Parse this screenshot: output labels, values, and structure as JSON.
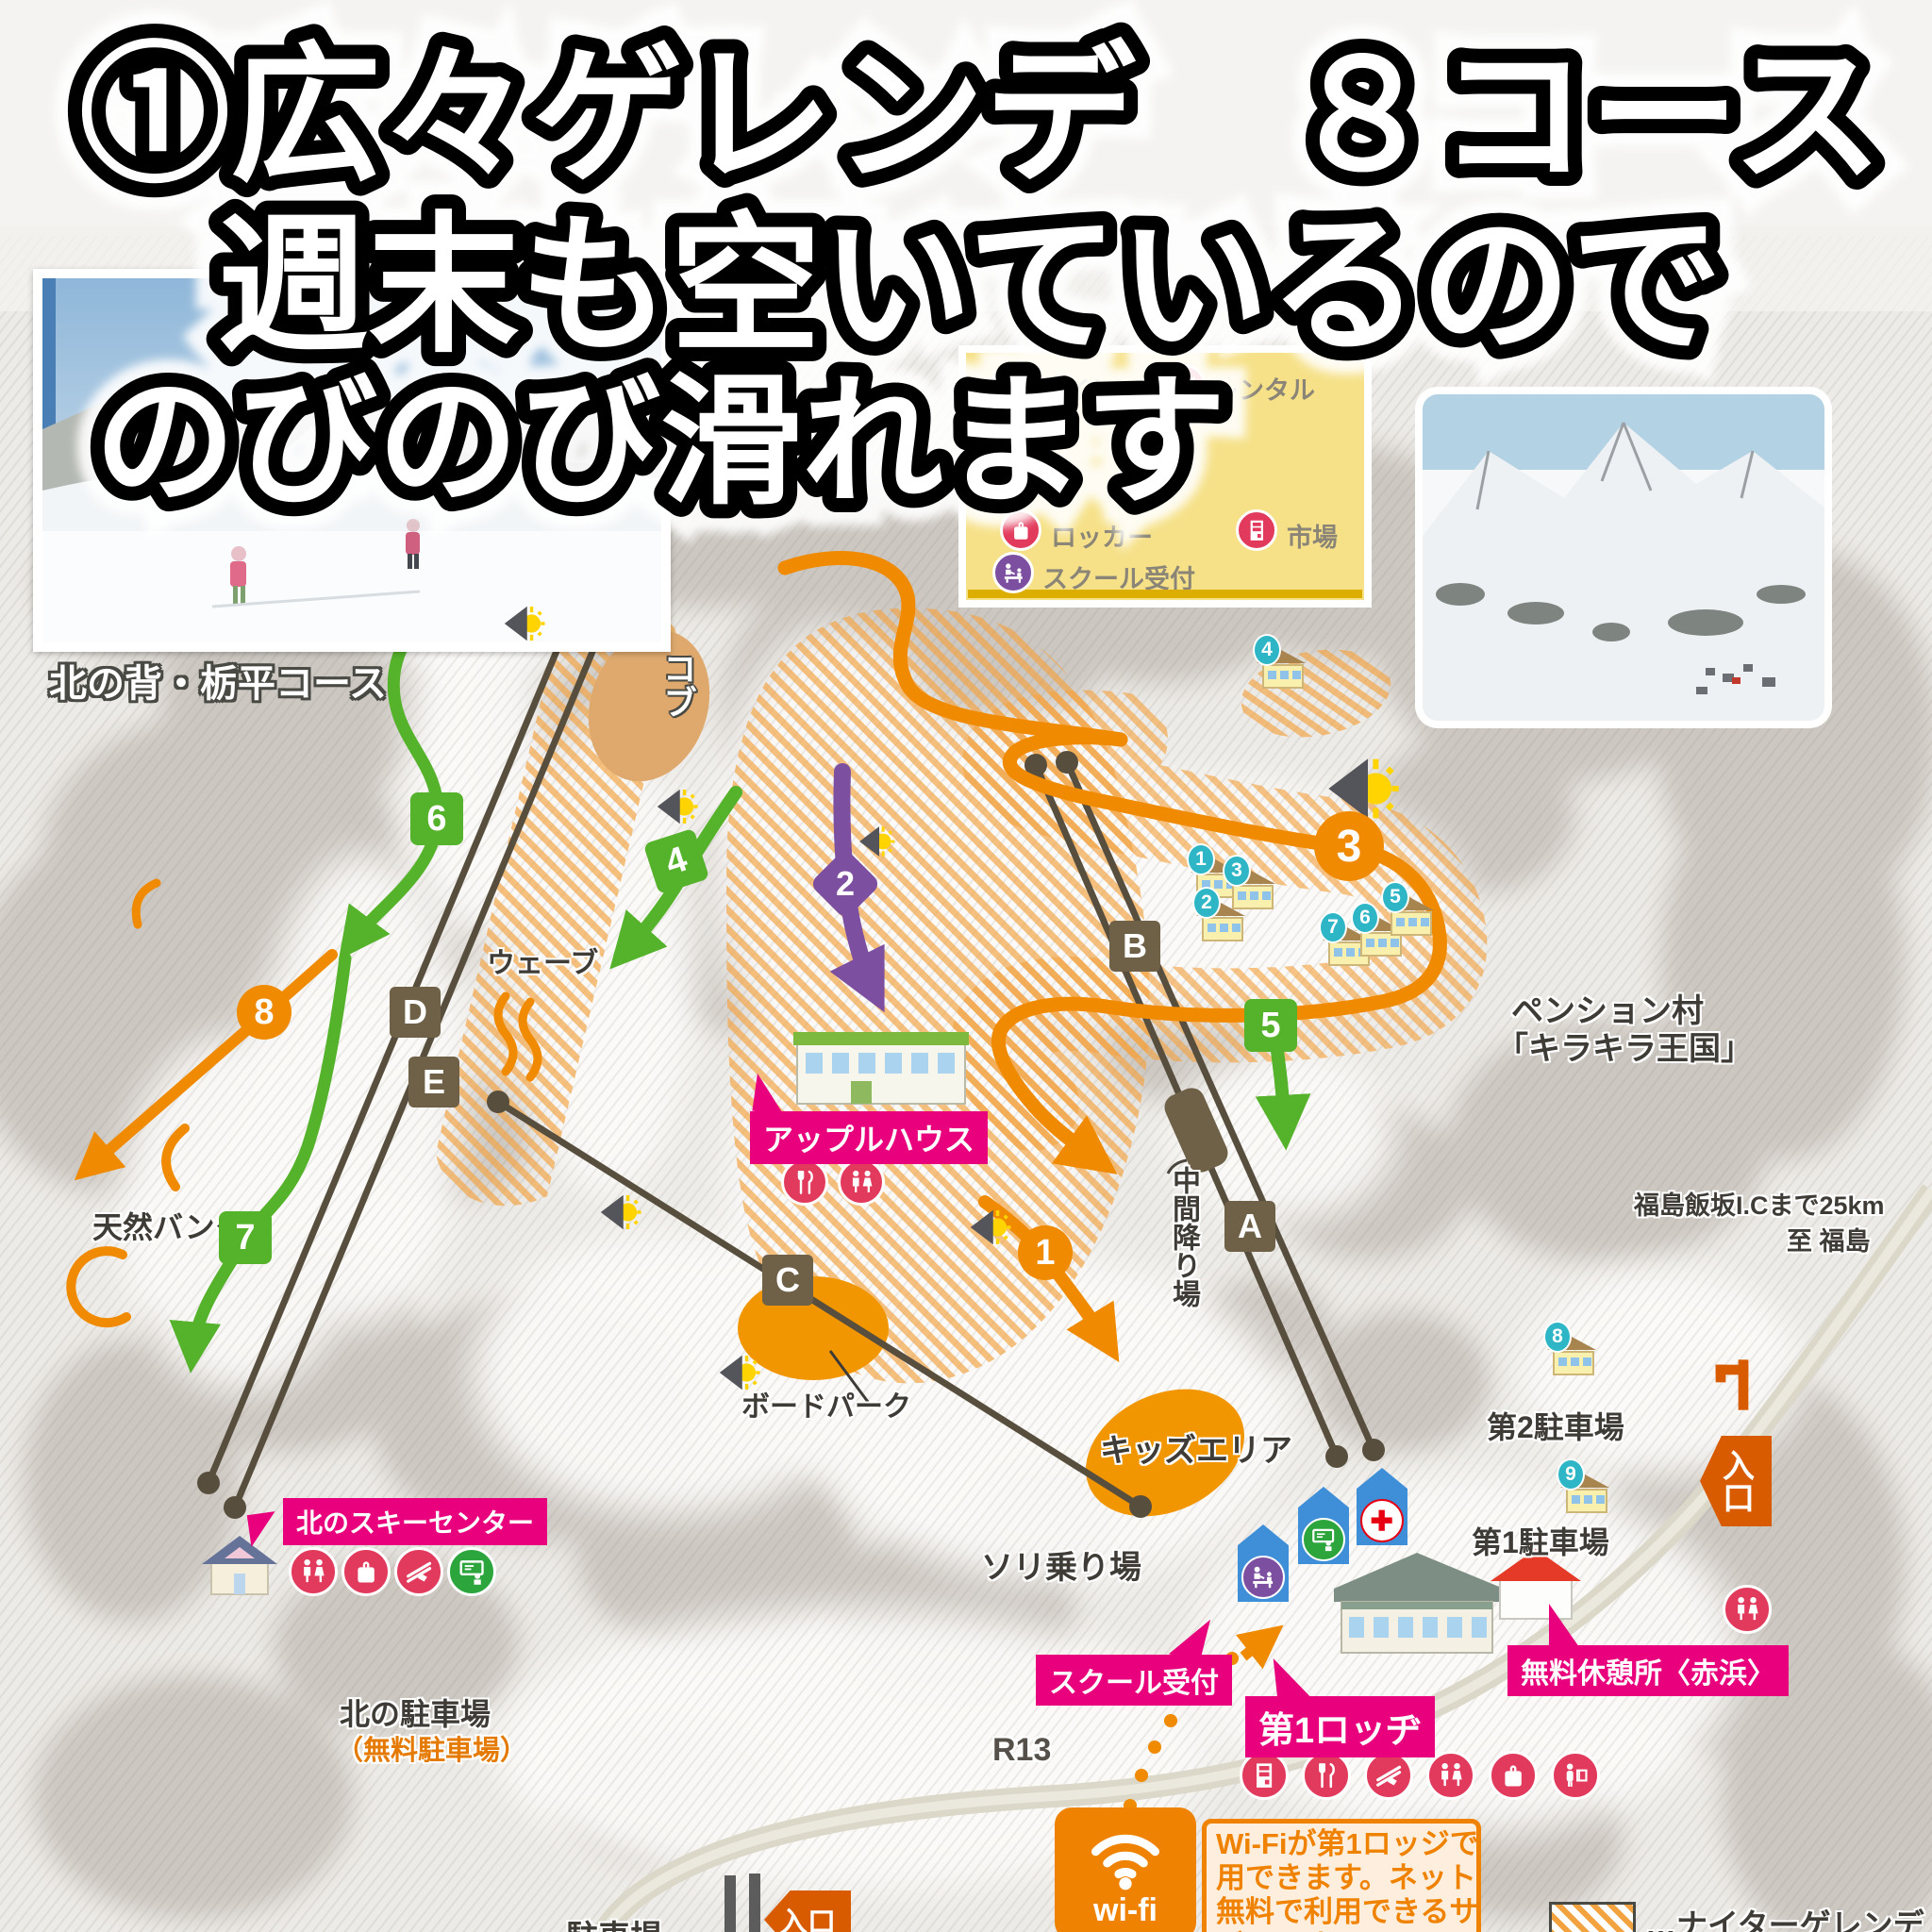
{
  "headline": {
    "line1": "①広々ゲレンデ　８コース",
    "line2": "週末も空いているので",
    "line3": "のびのび滑れます"
  },
  "photo_top_left": {
    "caption": "北の背・栃平コース"
  },
  "legend_box": {
    "items": [
      {
        "icon": "toilet-icon",
        "label": "トイレ"
      },
      {
        "icon": "rental-icon",
        "label": "レンタル"
      },
      {
        "icon": "locker-icon",
        "label": "ロッカー"
      },
      {
        "icon": "market-icon",
        "label": "市場"
      },
      {
        "icon": "school-reception-icon",
        "label": "スクール受付"
      }
    ]
  },
  "map": {
    "course_markers": [
      {
        "number": "1",
        "shape": "circle",
        "color": "#f08a00"
      },
      {
        "number": "2",
        "shape": "diamond",
        "color": "#7c4fa0"
      },
      {
        "number": "3",
        "shape": "circle",
        "color": "#f08a00"
      },
      {
        "number": "4",
        "shape": "square",
        "color": "#55b22b"
      },
      {
        "number": "5",
        "shape": "square",
        "color": "#55b22b"
      },
      {
        "number": "6",
        "shape": "square",
        "color": "#55b22b"
      },
      {
        "number": "7",
        "shape": "square",
        "color": "#55b22b"
      },
      {
        "number": "8",
        "shape": "circle",
        "color": "#f08a00"
      }
    ],
    "lift_markers": [
      {
        "letter": "A"
      },
      {
        "letter": "B"
      },
      {
        "letter": "C"
      },
      {
        "letter": "D"
      },
      {
        "letter": "E"
      }
    ],
    "labels": {
      "wave": "ウェーブ",
      "moguls": "コブ",
      "natural_bank": "天然バンク",
      "apple_house": "アップルハウス",
      "mid_station": "中間降り場",
      "pension_village_1": "ペンション村",
      "pension_village_2": "「キラキラ王国」",
      "access_1": "福島飯坂I.Cまで25km",
      "access_2": "至 福島",
      "board_park": "ボードパーク",
      "kids_area": "キッズエリア",
      "sled_area": "ソリ乗り場",
      "school_reception": "スクール受付",
      "north_ski_center": "北のスキーセンター",
      "north_parking": "北の駐車場",
      "north_parking_sub": "（無料駐車場）",
      "parking_1": "第1駐車場",
      "parking_2": "第2駐車場",
      "rest_house": "無料休憩所〈赤浜〉",
      "lodge_1": "第1ロッヂ",
      "entrance": "入口",
      "route": "R13",
      "bottom_cut": "駐車場"
    },
    "pension_house_numbers": [
      "1",
      "2",
      "3",
      "4",
      "5",
      "6",
      "7",
      "8",
      "9"
    ],
    "night_legend_label": "…ナイターゲレンデ"
  },
  "wifi": {
    "badge": "wi-fi",
    "lines": [
      "Wi-Fiが第1ロッジで使",
      "用できます。ネットが",
      "無料で利用できるサー",
      "ビスです。"
    ]
  },
  "colors": {
    "pink_label": "#e8007d",
    "course_orange": "#f08a00",
    "course_green": "#55b22b",
    "course_purple": "#7c4fa0",
    "lift_brown": "#6e6148",
    "house_number_teal": "#2eb6c6",
    "facility_red": "#e23a5c",
    "entrance_orange": "#d95b00",
    "legend_yellow": "#f6e189"
  }
}
